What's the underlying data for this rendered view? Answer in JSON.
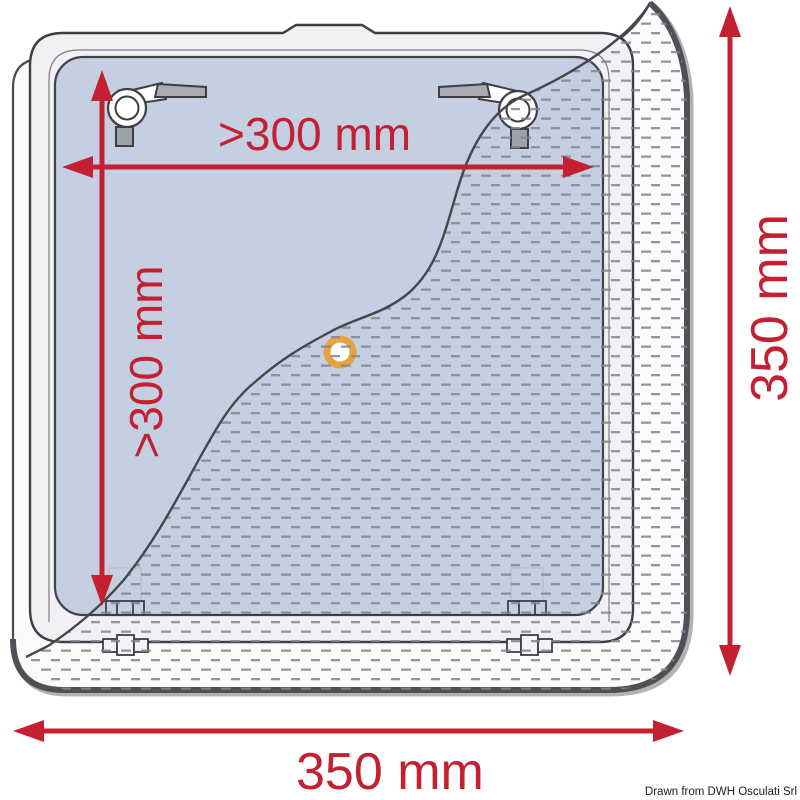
{
  "diagram": {
    "description": "Technical installation drawing of a square roof hatch / vent with cutaway hatched texture",
    "labels": {
      "inner_width": ">300 mm",
      "inner_height": ">300 mm",
      "outer_width": "350 mm",
      "outer_height": "350 mm"
    },
    "watermark": "Drawn from DWH Osculati Srl",
    "colors": {
      "dimension_red": "#C32032",
      "glass_blue": "#C4CFE2",
      "lid_gray": "#F1F1F3",
      "flange_white": "#FBFBFC",
      "outline_dark": "#3E3E44",
      "hatch_gray": "#80868E",
      "knob_orange": "#E8A23E",
      "metal_gray": "#A7ABB2"
    }
  }
}
